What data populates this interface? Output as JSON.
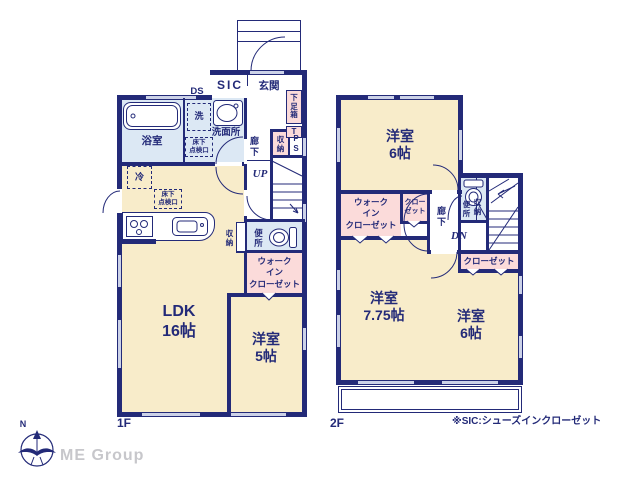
{
  "colors": {
    "wall": "#232a78",
    "cream": "#f8ecca",
    "blue": "#dce8f4",
    "pink": "#fbdbda",
    "win": "#ccd2e8",
    "brand": "#c7c7cb",
    "paper": "#ffffff"
  },
  "floor1": {
    "floor_label": "1F",
    "rooms": {
      "ldk": "LDK\n16帖",
      "bedroom5": "洋室\n5帖",
      "bathroom": "浴室",
      "washroom": "洗面所",
      "washer": "洗",
      "hatch_wash": "床下\n点検口",
      "hatch_ldk": "床下\n点検口",
      "fridge": "冷",
      "sic": "SIC",
      "genkan": "玄関",
      "shoebox": "下\n足\n箱",
      "shoebox_t": "T",
      "ds": "DS",
      "hall": "廊\n下",
      "storage_hall": "収\n納",
      "ps": "P\nS",
      "up": "UP",
      "toilet": "便\n所",
      "storage_toilet": "収\n納",
      "wic": "ウォーク\nイン\nクローゼット"
    }
  },
  "floor2": {
    "floor_label": "2F",
    "note": "※SIC:シューズインクローゼット",
    "rooms": {
      "bedroom6_top": "洋室\n6帖",
      "bedroom775": "洋室\n7.75帖",
      "bedroom6_bottom": "洋室\n6帖",
      "wic": "ウォーク\nイン\nクローゼット",
      "closet_small": "クロー\nゼット",
      "closet_bottom": "クローゼット",
      "hall": "廊\n下",
      "toilet": "便\n所",
      "storage": "収\n納",
      "dn": "DN"
    }
  },
  "footer": {
    "compass_n": "N",
    "brand": "ME Group"
  }
}
